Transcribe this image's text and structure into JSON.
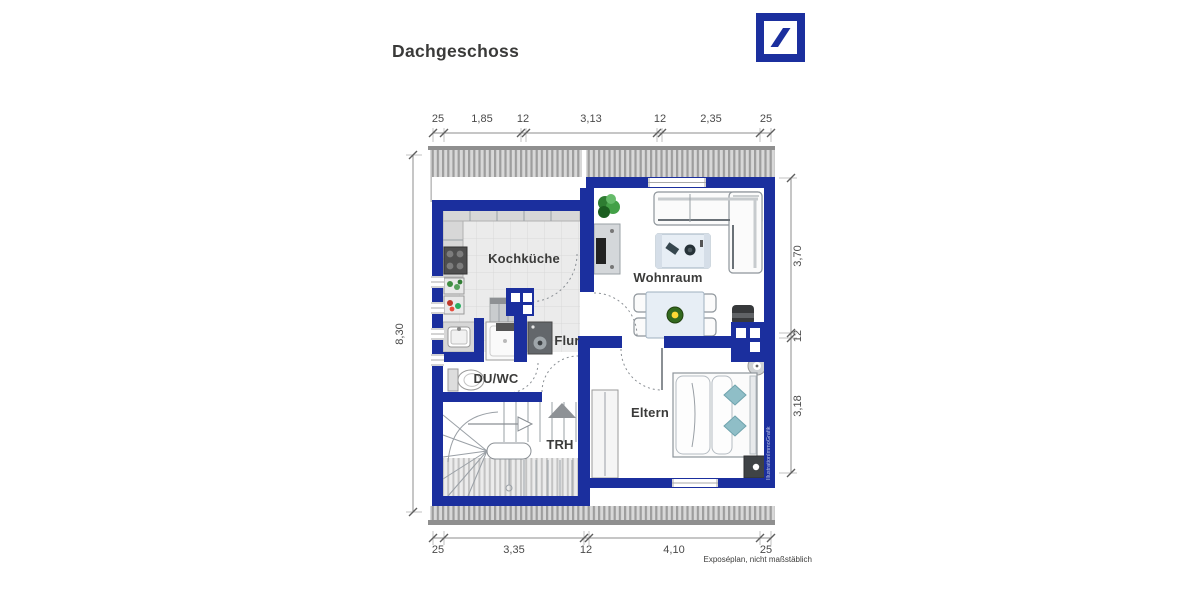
{
  "header": {
    "title": "Dachgeschoss"
  },
  "footer": {
    "caption": "Exposéplan, nicht maßstäblich"
  },
  "watermark": "IllustrationImmoGrafik",
  "rooms": {
    "kochkueche": {
      "label": "Kochküche"
    },
    "wohnraum": {
      "label": "Wohnraum"
    },
    "flur": {
      "label": "Flur"
    },
    "duwc": {
      "label": "DU/WC"
    },
    "trh": {
      "label": "TRH"
    },
    "eltern": {
      "label": "Eltern"
    }
  },
  "dimensions": {
    "top": [
      "25",
      "1,85",
      "12",
      "3,13",
      "12",
      "2,35",
      "25"
    ],
    "bottom": [
      "25",
      "3,35",
      "12",
      "4,10",
      "25"
    ],
    "left": [
      "8,30"
    ],
    "right": [
      "3,70",
      "12",
      "3,18"
    ]
  },
  "colors": {
    "wall": "#1b2f9e"
  }
}
